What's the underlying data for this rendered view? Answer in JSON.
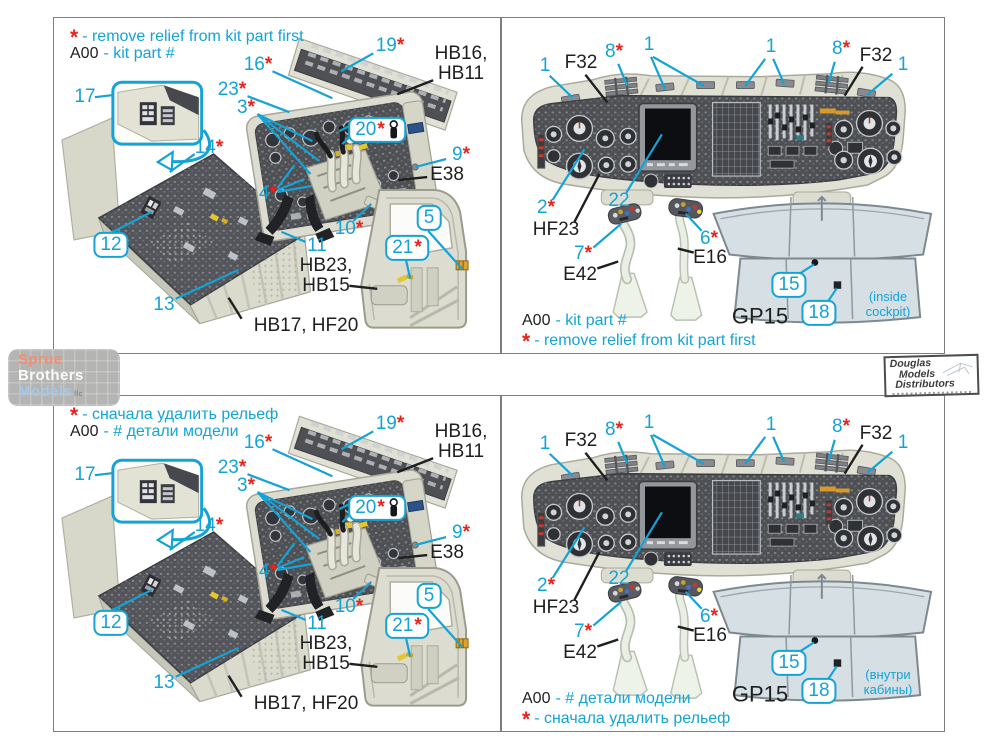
{
  "colors": {
    "accent": "#14a3d6",
    "asterisk": "#e8221d",
    "label": "#1f1f1f"
  },
  "quadrants": {
    "top_left": {
      "header": {
        "asterisk": "*",
        "line1": "- remove relief from kit part first",
        "part_code": "A00",
        "line2": "- kit part #"
      }
    },
    "top_right": {
      "footer": {
        "part_code": "A00",
        "line1": "- kit part #",
        "asterisk": "*",
        "line2": "- remove relief from kit part first"
      },
      "note": "(inside\ncockpit)"
    },
    "bottom_left": {
      "header": {
        "asterisk": "*",
        "line1": "- сначала удалить рельеф",
        "part_code": "A00",
        "line2": "- # детали модели"
      }
    },
    "bottom_right": {
      "footer": {
        "part_code": "A00",
        "line1": "- # детали модели",
        "asterisk": "*",
        "line2": "- сначала удалить рельеф"
      },
      "note": "(внутри\nкабины)"
    }
  },
  "callouts": {
    "left": [
      {
        "id": "c16",
        "text": "16",
        "ast": true
      },
      {
        "id": "c23",
        "text": "23",
        "ast": true
      },
      {
        "id": "c3",
        "text": "3",
        "ast": true
      },
      {
        "id": "c19",
        "text": "19",
        "ast": true
      },
      {
        "id": "c20",
        "text": "20",
        "ast": true,
        "boxed": true,
        "icon": "lever-icon"
      },
      {
        "id": "c9",
        "text": "9",
        "ast": true
      },
      {
        "id": "c10",
        "text": "10",
        "ast": true
      },
      {
        "id": "c4",
        "text": "4",
        "ast": true
      },
      {
        "id": "c14",
        "text": "14",
        "ast": true
      },
      {
        "id": "c17",
        "text": "17"
      },
      {
        "id": "c12",
        "text": "12",
        "boxed": true
      },
      {
        "id": "c13",
        "text": "13"
      },
      {
        "id": "c11",
        "text": "11"
      },
      {
        "id": "c5",
        "text": "5",
        "boxed": true
      },
      {
        "id": "c21",
        "text": "21",
        "ast": true,
        "boxed": true
      },
      {
        "id": "hb16",
        "text": "HB16,\nHB11",
        "black": true
      },
      {
        "id": "e38",
        "text": "E38",
        "black": true
      },
      {
        "id": "hb23",
        "text": "HB23,\nHB15",
        "black": true
      },
      {
        "id": "hb17",
        "text": "HB17, HF20",
        "black": true
      }
    ],
    "right": [
      {
        "id": "r1a",
        "text": "1"
      },
      {
        "id": "f32l",
        "text": "F32",
        "black": true
      },
      {
        "id": "r8l",
        "text": "8",
        "ast": true
      },
      {
        "id": "r1b",
        "text": "1"
      },
      {
        "id": "r1c",
        "text": "1"
      },
      {
        "id": "r8r",
        "text": "8",
        "ast": true
      },
      {
        "id": "f32r",
        "text": "F32",
        "black": true
      },
      {
        "id": "r1d",
        "text": "1"
      },
      {
        "id": "r2",
        "text": "2",
        "ast": true
      },
      {
        "id": "hf23",
        "text": "HF23",
        "black": true
      },
      {
        "id": "r22",
        "text": "22"
      },
      {
        "id": "r7",
        "text": "7",
        "ast": true
      },
      {
        "id": "e42",
        "text": "E42",
        "black": true
      },
      {
        "id": "r6",
        "text": "6",
        "ast": true
      },
      {
        "id": "e16",
        "text": "E16",
        "black": true
      },
      {
        "id": "r15",
        "text": "15",
        "boxed": true
      },
      {
        "id": "r18",
        "text": "18",
        "boxed": true
      },
      {
        "id": "gp15",
        "text": "GP15",
        "black": true,
        "large": true
      }
    ]
  },
  "logo": {
    "line1": "Sprue",
    "line2": "Brothers",
    "line3": "Models",
    "suffix": "llc"
  },
  "stamp": {
    "line1": "Douglas",
    "line2": "Models",
    "line3": "Distributors"
  }
}
